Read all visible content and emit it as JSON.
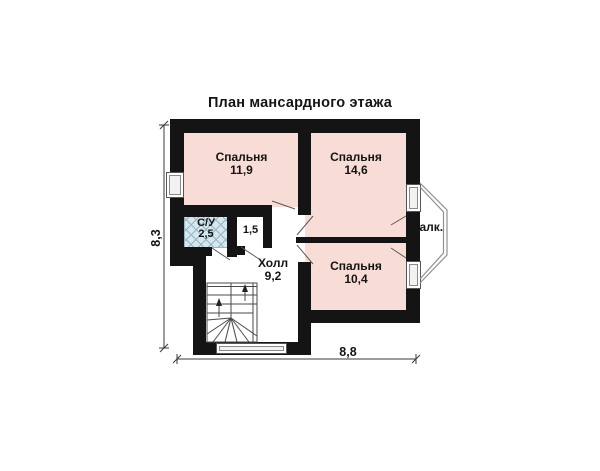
{
  "title": "План мансардного этажа",
  "rooms": {
    "bedroom1": {
      "name": "Спальня",
      "area": "11,9"
    },
    "bedroom2": {
      "name": "Спальня",
      "area": "14,6"
    },
    "bedroom3": {
      "name": "Спальня",
      "area": "10,4"
    },
    "bathroom": {
      "name": "С/У",
      "area": "2,5"
    },
    "closet": {
      "area": "1,5"
    },
    "hall": {
      "name": "Холл",
      "area": "9,2"
    },
    "balcony": {
      "name": "Балк."
    }
  },
  "dimensions": {
    "height_m": "8,3",
    "width_m": "8,8"
  },
  "colors": {
    "wall": "#141414",
    "room_fill": "#f8ddd6",
    "bathroom_fill": "#d7e7ee",
    "hatch_line": "#93b7c6",
    "outline": "#5a5a5a",
    "dimension": "#3a3a3a",
    "text": "#141414"
  }
}
